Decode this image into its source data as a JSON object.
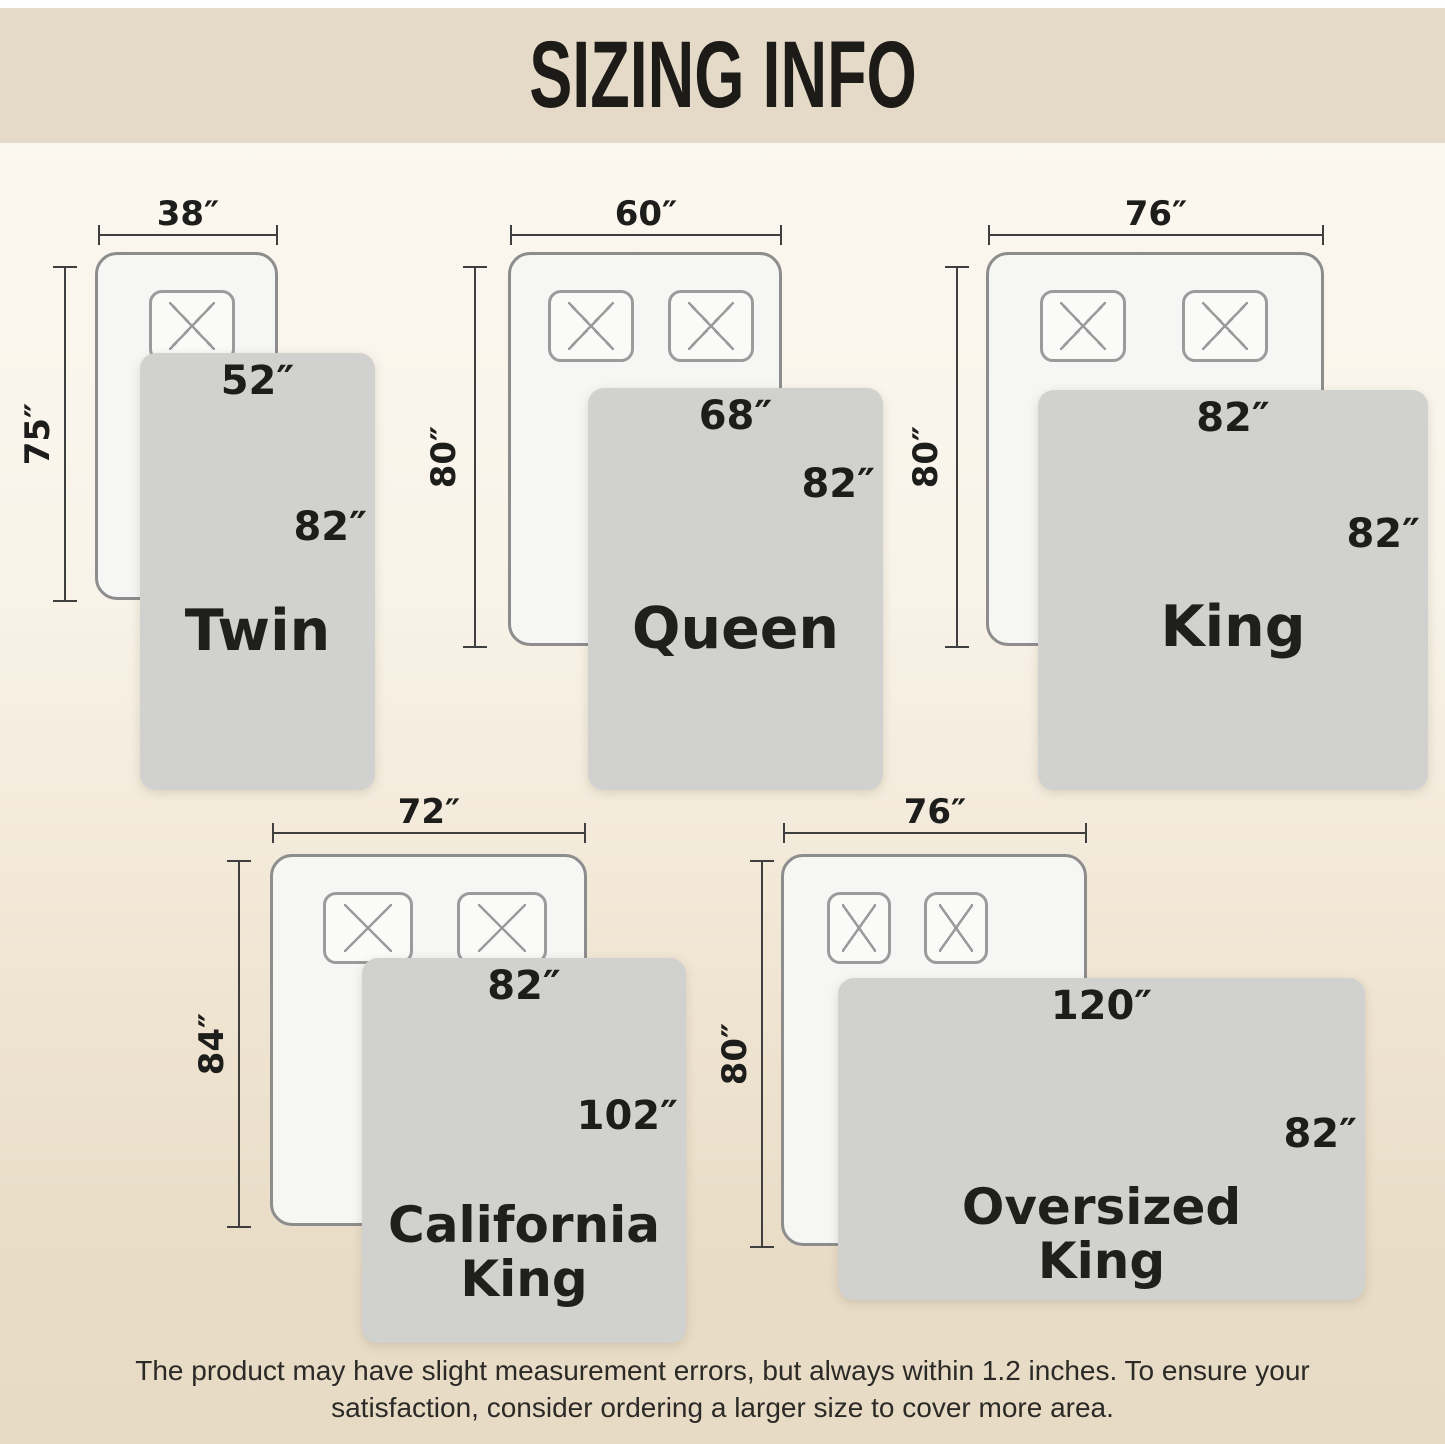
{
  "page_title": "SIZING INFO",
  "colors": {
    "header_band": "#e4dac7",
    "background_top": "#fcfbf8",
    "background_bottom": "#e7dbc6",
    "bed_fill": "#f6f6f5",
    "bed_border": "#8d8d8d",
    "blanket_fill": "#d1d1d0",
    "dimension_line": "#3f3f3f",
    "text": "#1d1d1b"
  },
  "sizes": [
    {
      "name": "Twin",
      "name_lines": [
        "Twin"
      ],
      "bed_width": "38″",
      "bed_length": "75″",
      "blanket_width": "52″",
      "blanket_length": "82″",
      "pillow_count": 1
    },
    {
      "name": "Queen",
      "name_lines": [
        "Queen"
      ],
      "bed_width": "60″",
      "bed_length": "80″",
      "blanket_width": "68″",
      "blanket_length": "82″",
      "pillow_count": 2
    },
    {
      "name": "King",
      "name_lines": [
        "King"
      ],
      "bed_width": "76″",
      "bed_length": "80″",
      "blanket_width": "82″",
      "blanket_length": "82″",
      "pillow_count": 2
    },
    {
      "name": "California King",
      "name_lines": [
        "California",
        "King"
      ],
      "bed_width": "72″",
      "bed_length": "84″",
      "blanket_width": "82″",
      "blanket_length": "102″",
      "pillow_count": 2
    },
    {
      "name": "Oversized King",
      "name_lines": [
        "Oversized",
        "King"
      ],
      "bed_width": "76″",
      "bed_length": "80″",
      "blanket_width": "120″",
      "blanket_length": "82″",
      "pillow_count": 2
    }
  ],
  "footer": {
    "line1": "The product may have slight measurement errors, but always within 1.2 inches. To ensure your",
    "line2": "satisfaction, consider ordering a larger size to cover more area."
  }
}
